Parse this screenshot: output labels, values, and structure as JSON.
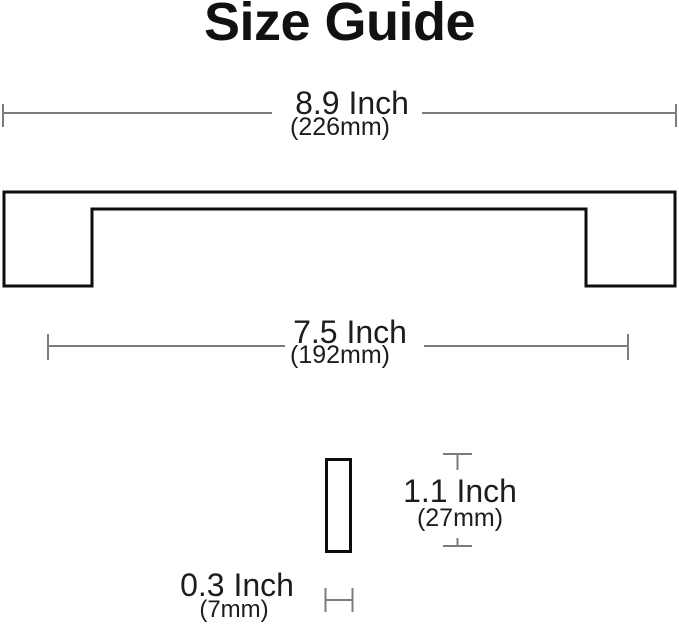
{
  "title": "Size Guide",
  "dimensions": {
    "overall_length": {
      "inch": "8.9 Inch",
      "mm": "(226mm)"
    },
    "hole_spacing": {
      "inch": "7.5 Inch",
      "mm": "(192mm)"
    },
    "height": {
      "inch": "1.1 Inch",
      "mm": "(27mm)"
    },
    "thickness": {
      "inch": "0.3 Inch",
      "mm": "(7mm)"
    }
  },
  "colors": {
    "background": "#ffffff",
    "text": "#1d1d1d",
    "title_text": "#111111",
    "outline": "#0d0d0d",
    "dimension_line": "#7c7c7c"
  }
}
